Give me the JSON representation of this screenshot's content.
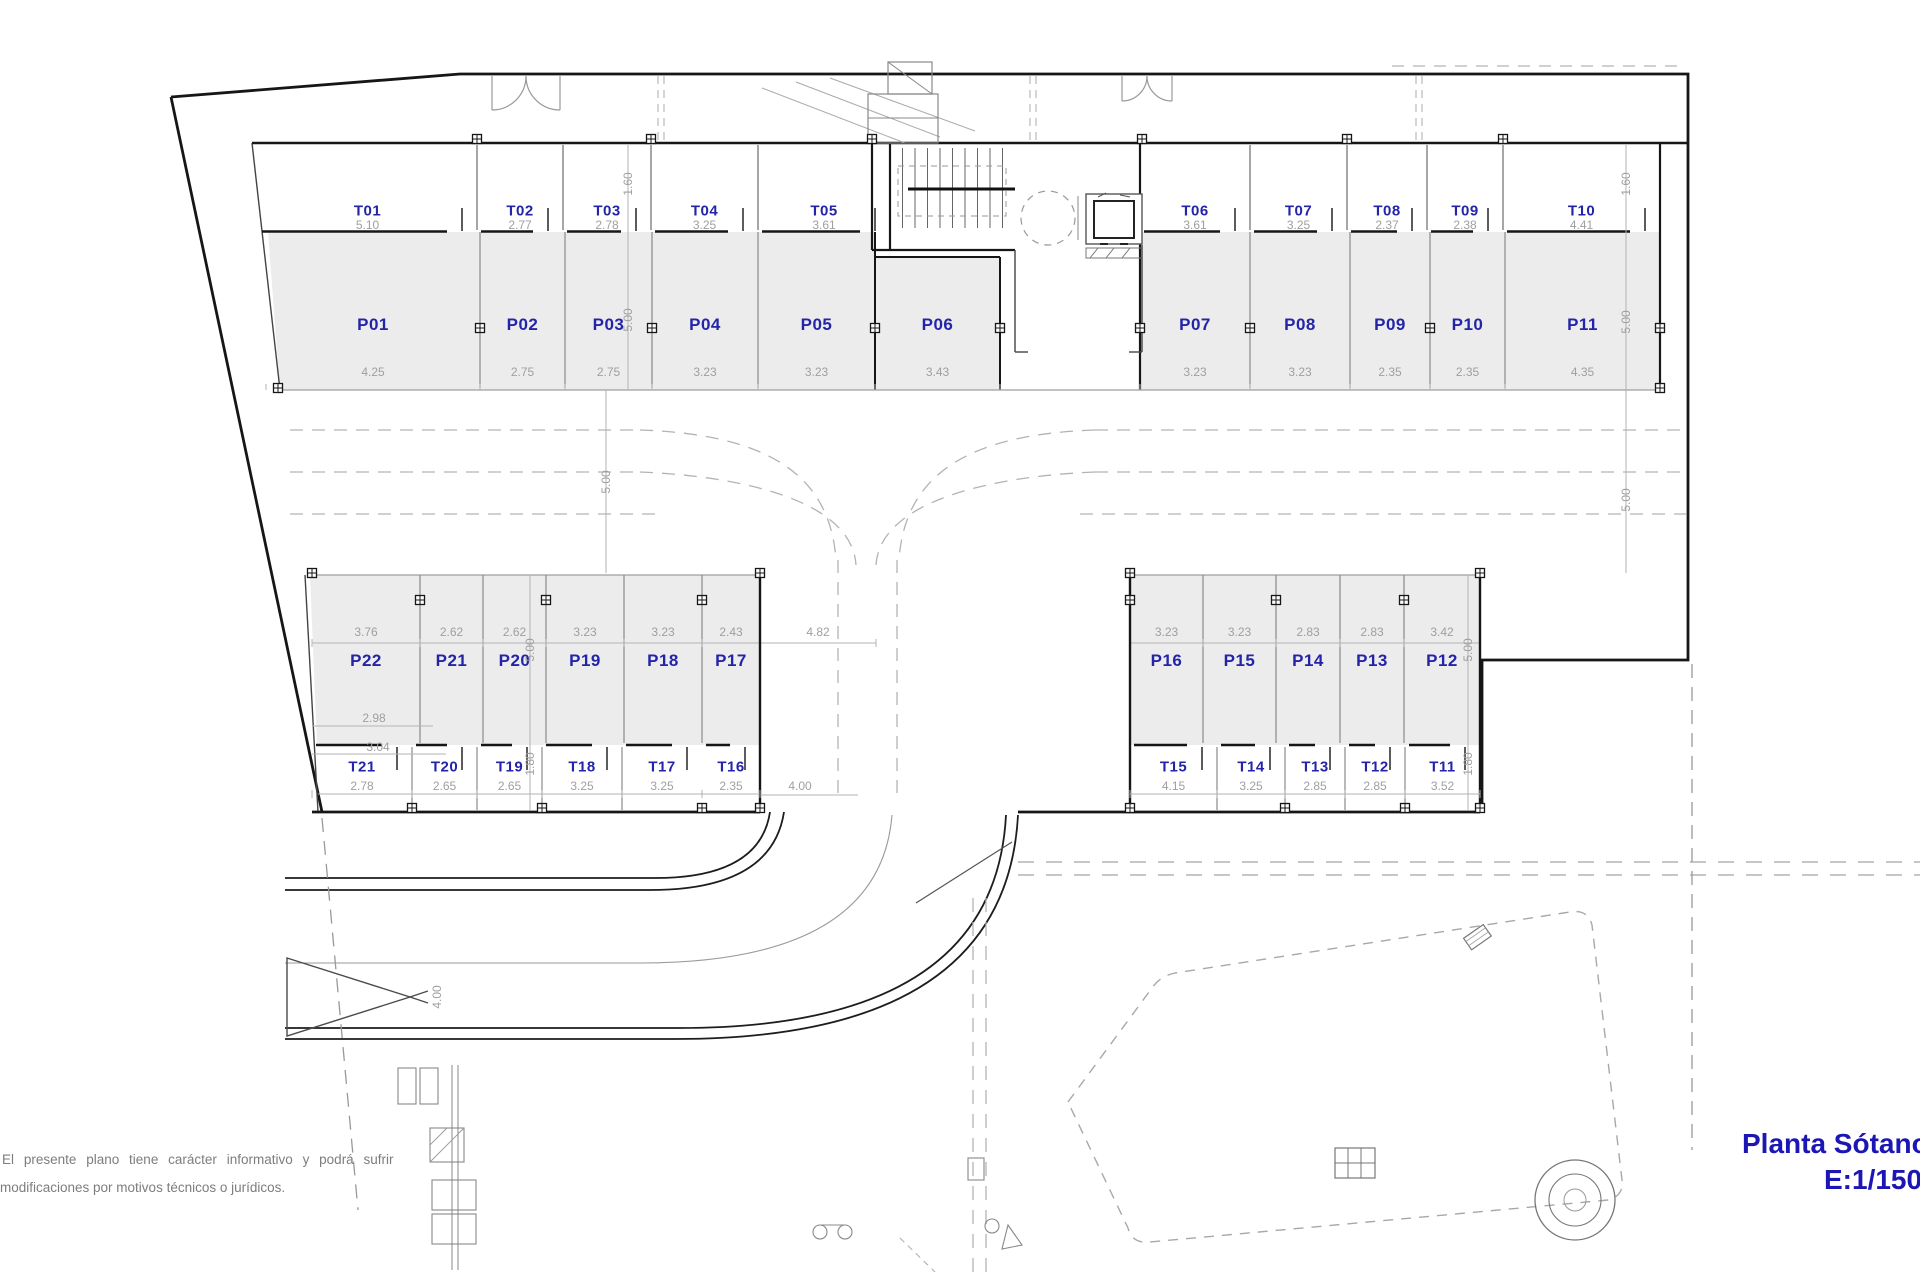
{
  "title": {
    "line1": "Planta Sótano",
    "line2": "E:1/150"
  },
  "disclaimer": {
    "line1": "El presente plano tiene carácter informativo y podrá sufrir",
    "line2": "modificaciones por motivos técnicos o jurídicos."
  },
  "colors": {
    "label_blue": "#2424a8",
    "title_blue": "#1b16b4",
    "dim_gray": "#9f9f9f",
    "stall_fill": "#ececec",
    "wall_dark": "#161616"
  },
  "rooms": {
    "top_storage": [
      {
        "id": "T01",
        "size": "5.10"
      },
      {
        "id": "T02",
        "size": "2.77"
      },
      {
        "id": "T03",
        "size": "2.78"
      },
      {
        "id": "T04",
        "size": "3.25"
      },
      {
        "id": "T05",
        "size": "3.61"
      },
      {
        "id": "T06",
        "size": "3.61"
      },
      {
        "id": "T07",
        "size": "3.25"
      },
      {
        "id": "T08",
        "size": "2.37"
      },
      {
        "id": "T09",
        "size": "2.38"
      },
      {
        "id": "T10",
        "size": "4.41"
      }
    ],
    "top_parking": [
      {
        "id": "P01",
        "size": "4.25"
      },
      {
        "id": "P02",
        "size": "2.75"
      },
      {
        "id": "P03",
        "size": "2.75"
      },
      {
        "id": "P04",
        "size": "3.23"
      },
      {
        "id": "P05",
        "size": "3.23"
      },
      {
        "id": "P06",
        "size": "3.43"
      },
      {
        "id": "P07",
        "size": "3.23"
      },
      {
        "id": "P08",
        "size": "3.23"
      },
      {
        "id": "P09",
        "size": "2.35"
      },
      {
        "id": "P10",
        "size": "2.35"
      },
      {
        "id": "P11",
        "size": "4.35"
      }
    ],
    "bottom_parking": [
      {
        "id": "P22",
        "size": "3.76"
      },
      {
        "id": "P21",
        "size": "2.62"
      },
      {
        "id": "P20",
        "size": "2.62"
      },
      {
        "id": "P19",
        "size": "3.23"
      },
      {
        "id": "P18",
        "size": "3.23"
      },
      {
        "id": "P17",
        "size": "2.43"
      },
      {
        "id": "P16",
        "size": "3.23"
      },
      {
        "id": "P15",
        "size": "3.23"
      },
      {
        "id": "P14",
        "size": "2.83"
      },
      {
        "id": "P13",
        "size": "2.83"
      },
      {
        "id": "P12",
        "size": "3.42"
      }
    ],
    "bottom_storage": [
      {
        "id": "T21",
        "size": "2.78"
      },
      {
        "id": "T20",
        "size": "2.65"
      },
      {
        "id": "T19",
        "size": "2.65"
      },
      {
        "id": "T18",
        "size": "3.25"
      },
      {
        "id": "T17",
        "size": "3.25"
      },
      {
        "id": "T16",
        "size": "2.35"
      },
      {
        "id": "T15",
        "size": "4.15"
      },
      {
        "id": "T14",
        "size": "3.25"
      },
      {
        "id": "T13",
        "size": "2.85"
      },
      {
        "id": "T12",
        "size": "2.85"
      },
      {
        "id": "T11",
        "size": "3.52"
      }
    ]
  },
  "side_dims": [
    {
      "v": "1.60"
    },
    {
      "v": "5.00"
    },
    {
      "v": "5.00"
    },
    {
      "v": "5.00"
    },
    {
      "v": "1.80"
    },
    {
      "v": "1.60"
    },
    {
      "v": "5.00"
    },
    {
      "v": "5.00"
    },
    {
      "v": "5.00"
    },
    {
      "v": "1.80"
    }
  ],
  "extra_dims": {
    "p22_a": "2.98",
    "p22_b": "3.04",
    "ramp_width": "4.82",
    "road_mouth": "4.00",
    "entry_ramp": "4.00"
  }
}
